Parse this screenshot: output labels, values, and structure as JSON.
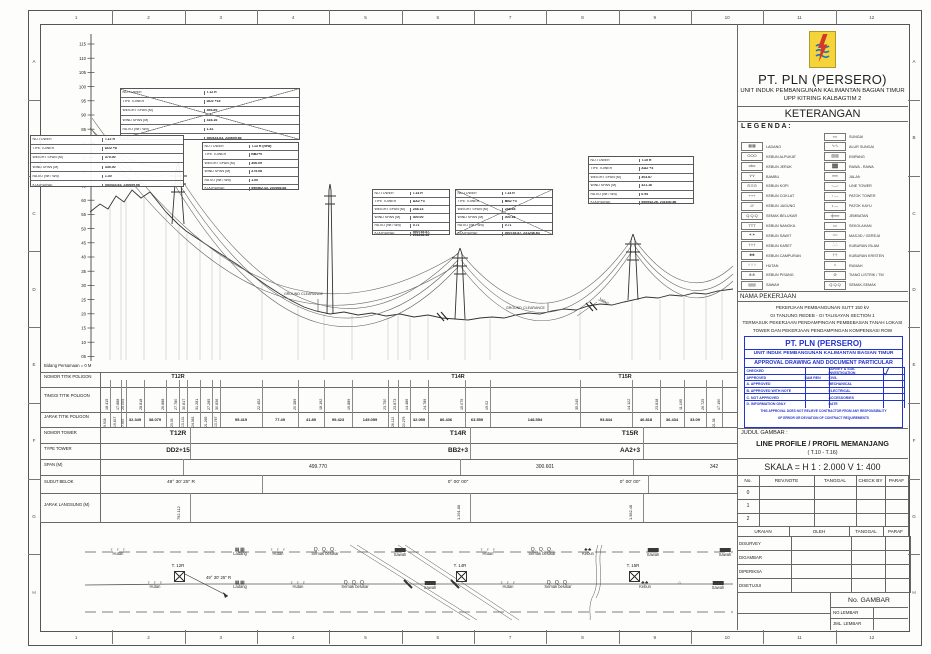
{
  "sheet": {
    "cols": [
      "1",
      "2",
      "3",
      "4",
      "5",
      "6",
      "7",
      "8",
      "9",
      "10",
      "11",
      "12"
    ],
    "rows": [
      "A",
      "B",
      "C",
      "D",
      "E",
      "F",
      "G",
      "H"
    ]
  },
  "header": {
    "company": "PT. PLN (PERSERO)",
    "unit": "UNIT INDUK PEMBANGUNAN KALIMANTAN BAGIAN TIMUR",
    "sub_unit": "UPP KITRING KALBAGTIM 2",
    "keterangan": "KETERANGAN",
    "legenda": "L E G E N D A :"
  },
  "legend_rows": [
    [
      "",
      "",
      "≈≈",
      "SUNGAI"
    ],
    [
      "▦▦",
      "LADANG",
      "∿∿",
      "ALUR SUNGAI"
    ],
    [
      "OOO",
      "KEBUN ALPUKAT",
      "▨▨",
      "EMPANG"
    ],
    [
      "obo",
      "KEBUN JERUK",
      "▓▓",
      "RAWA - RAWA"
    ],
    [
      "⋎⋎",
      "BAMBU",
      "══",
      "JALAN"
    ],
    [
      "⊙⊙⊙",
      "KEBUN KOPI",
      "▫—▫",
      "LINE TOWER"
    ],
    [
      "+++",
      "KEBUN COKLAT",
      "▫ —",
      "PATOK TOWER"
    ],
    [
      "///",
      "KEBUN JAGUNG",
      "• —",
      "PATOK KAYU"
    ],
    [
      "Q.Q.Q",
      "SEMAK BELUKAR",
      "╪══",
      "JEMBATAN"
    ],
    [
      "TTT",
      "KEBUN NANGKA",
      "▭",
      "SEKOLAHAN"
    ],
    [
      "✶✶",
      "KEBUN SAWIT",
      "⌂⌂",
      "MASJID / GEREJA"
    ],
    [
      "†††",
      "KEBUN KARET",
      "∴∴",
      "KUBURAN ISLAM"
    ],
    [
      "♣♣",
      "KEBUN CAMPURAN",
      "††",
      "KUBURAN KRISTEN"
    ],
    [
      "♀♀♀",
      "HUTAN",
      "⌂",
      "RUMAH"
    ],
    [
      "⋔⋔",
      "KEBUN PISANG",
      "⊘",
      "TIANG LISTRIK / TM"
    ],
    [
      "▤▤",
      "SAWAH",
      "Q.Q.Q",
      "SEMAK-SEMAK"
    ]
  ],
  "job": {
    "label": "NAMA PEKERJAAN",
    "lines": [
      "PEKERJAAN PEMBANGUNAN SUTT 150 kV",
      "GI TANJUNG REDEB - GI TALISAYAN SECTION 1",
      "TERMASUK PEKERJAAN PENDAMPINGAN PEMBEBASAN TANAH LOKASI",
      "TOWER DAN PEKERJAAN PENDAMPINGAN KOMPENSASI ROW"
    ]
  },
  "stamp": {
    "company": "PT. PLN (PERSERO)",
    "unit": "UNIT  INDUK PEMBANGUNAN KALIMANTAN BAGIAN TIMUR",
    "title": "APPROVAL DRAWING AND DOCUMENT PARTICULAR",
    "left": [
      "CHECKED",
      "APPROVED",
      "A. APPROVED",
      "B. APPROVED WITH NOTE",
      "C. NOT APPROVED",
      "D. INFORMATION ONLY"
    ],
    "left_vals": [
      "",
      "SAM REN",
      "",
      "",
      "",
      ""
    ],
    "right": [
      "SURVEY & SOIL INVESTIGATION",
      "CIVIL",
      "MECHANICAL",
      "ELECTRICAL",
      "ACCESSORIES",
      "DATE"
    ],
    "check_mark": "✓",
    "footer1": "THIS APPROVAL DOES NOT RELIEVE CONTRACTOR FROM ANY RESPONSIBILITY",
    "footer2": "OF ERROR OR DEVIATION OF CONTRACT REQUIREMENTS"
  },
  "title_box": {
    "label": "JUDUL GAMBAR :",
    "line1": "LINE PROFILE / PROFIL MEMANJANG",
    "line2": "( T.10 - T.16)",
    "skala": "SKALA   =   H 1 : 2.000      V 1: 400"
  },
  "rev": {
    "headers": [
      "No.",
      "REV.NOTE",
      "TANGGAL",
      "CHECK BY",
      "PARAF"
    ],
    "rows": [
      "0",
      "1",
      "2"
    ]
  },
  "uraian": {
    "headers": [
      "URAIAN",
      "OLEH",
      "TANGGAL",
      "PARAF"
    ],
    "rows": [
      "DISURVEY",
      "DIGAMBAR",
      "DIPERIKSA",
      "DISETUJUI"
    ]
  },
  "numbers": {
    "no_gambar": "No. GAMBAR",
    "no_lembar": "NO.LEMBAR",
    "jml_lembar": "JML. LEMBAR"
  },
  "profile": {
    "datum": "Bidang Persamaan = 0 M",
    "axis": [
      "115",
      "110",
      "105",
      "100",
      "95",
      "90",
      "85",
      "80",
      "75",
      "70",
      "65",
      "60",
      "55",
      "50",
      "45",
      "40",
      "35",
      "30",
      "25",
      "20",
      "15",
      "10",
      "05"
    ],
    "gc": "GROUND CLEARANCE",
    "jalan": "Jalan",
    "row_labels": [
      "NO.TOWER",
      "TIPE TOWER",
      "WEIGHT SPAN (M)",
      "WIND SPAN (M)",
      "RATIO (Wt / Wd)",
      "KOORDINAT"
    ],
    "tables": [
      {
        "x": 120,
        "y": 88,
        "w": 178,
        "h": 50,
        "crossed": true,
        "vals": [
          "T.12 R",
          "DD2 +15",
          "494.89",
          "416.16",
          "1.41",
          "550434.63, 230659.66"
        ]
      },
      {
        "x": 30,
        "y": 135,
        "w": 152,
        "h": 50,
        "crossed": false,
        "vals": [
          "T.12 R",
          "DD2 +8",
          "375.00",
          "335.00",
          "1.30",
          "550434.63, 230659.66"
        ]
      },
      {
        "x": 202,
        "y": 142,
        "w": 95,
        "h": 46,
        "crossed": false,
        "vals": [
          "T.13 R (new)",
          "BB2+0",
          "306.09",
          "375.08",
          "1.00",
          "550562.43, 230936.88"
        ]
      },
      {
        "x": 372,
        "y": 189,
        "w": 76,
        "h": 44,
        "crossed": false,
        "vals": [
          "T.14 R",
          "AA2 +3",
          "248.13",
          "300.00",
          "0.71",
          "550745.87, 231246.63"
        ]
      },
      {
        "x": 455,
        "y": 189,
        "w": 96,
        "h": 44,
        "crossed": true,
        "vals": [
          "T.14 R",
          "BB2 +3",
          "248.48",
          "400.16",
          "0.71",
          "550745.87, 231246.63"
        ]
      },
      {
        "x": 588,
        "y": 156,
        "w": 104,
        "h": 46,
        "crossed": false,
        "vals": [
          "T.15 R",
          "AA2 +3",
          "303.67",
          "321.16",
          "0.94",
          "550943.26, 231630.86"
        ]
      }
    ]
  },
  "band": {
    "labels": [
      "NOMOR TITIK POLIGON",
      "TINGGI TITIK POLIGON",
      "JARAK TITIK POLIGON",
      "NOMOR TOWER",
      "TYPE TOWER",
      "SPAN (M)",
      "SUDUT BELOK",
      "JARAK LANGSUNG (M)"
    ],
    "stations": [
      110,
      121,
      126,
      144,
      166,
      179,
      187,
      200,
      212,
      220,
      262,
      298,
      324,
      352,
      388,
      398,
      410,
      428,
      465,
      490,
      580,
      632,
      660,
      684,
      706,
      722
    ],
    "tinggi": [
      "18.415",
      "17.888",
      "25.005",
      "28.818",
      "26.888",
      "27.780",
      "30.817",
      "31.281",
      "27.285",
      "30.836",
      "22.452",
      "20.389",
      "18.192",
      "19.889",
      "23.750",
      "23.873",
      "14.486",
      "24.789",
      "15.075",
      "19.02",
      "35.245",
      "14.122",
      "23.818",
      "11.195",
      "26.725",
      "17.190"
    ],
    "jarak": [
      [
        "9.908",
        105,
        1
      ],
      [
        "19.817",
        115,
        1
      ],
      [
        "7.957",
        123,
        1
      ],
      [
        "32.349",
        135,
        0
      ],
      [
        "38.079",
        155,
        0
      ],
      [
        "23.35",
        172,
        1
      ],
      [
        "13.131",
        183,
        1
      ],
      [
        "24.363",
        193,
        1
      ],
      [
        "21.265",
        206,
        1
      ],
      [
        "13.747",
        216,
        1
      ],
      [
        "95.419",
        241,
        0
      ],
      [
        "77.49",
        280,
        0
      ],
      [
        "41.89",
        311,
        0
      ],
      [
        "99.423",
        338,
        0
      ],
      [
        "145.059",
        370,
        0
      ],
      [
        "26.112",
        393,
        1
      ],
      [
        "20.279",
        404,
        1
      ],
      [
        "32.059",
        419,
        0
      ],
      [
        "86.436",
        446,
        0
      ],
      [
        "63.559",
        477,
        0
      ],
      [
        "148.554",
        535,
        0
      ],
      [
        "93.844",
        606,
        0
      ],
      [
        "46.818",
        646,
        0
      ],
      [
        "36.434",
        672,
        0
      ],
      [
        "33.09",
        695,
        0
      ],
      [
        "21.36",
        714,
        1
      ]
    ],
    "poligon_towers": [
      [
        "T12R",
        178
      ],
      [
        "T14R",
        458
      ],
      [
        "T15R",
        625
      ]
    ],
    "nomor": [
      [
        "T12R",
        178
      ],
      [
        "T14R",
        458
      ],
      [
        "T15R",
        630
      ]
    ],
    "type": [
      [
        "DD2+15",
        178
      ],
      [
        "BB2+3",
        458
      ],
      [
        "AA2+3",
        630
      ]
    ],
    "span": [
      [
        "499.770",
        318
      ],
      [
        "300.601",
        545
      ],
      [
        "342",
        714
      ]
    ],
    "sudut": [
      [
        "49° 30' 25\" R",
        181
      ],
      [
        "0° 00' 00\"",
        458
      ],
      [
        "0° 00' 00\"",
        630
      ]
    ],
    "jarak_langsung": [
      [
        "792.112",
        178
      ],
      [
        "1.291.88",
        458
      ],
      [
        "1.582.48",
        630
      ]
    ]
  },
  "plan": {
    "angle": "49° 30' 25\" R",
    "towers": [
      [
        "T. 12R",
        178
      ],
      [
        "T. 14R",
        460
      ],
      [
        "T. 15R",
        633
      ]
    ],
    "items_top": [
      [
        "hutan",
        "Hutan",
        118
      ],
      [
        "ladang",
        "Ladang",
        240
      ],
      [
        "hutan",
        "Hutan",
        278
      ],
      [
        "semak",
        "Semak belukar",
        325
      ],
      [
        "sawah",
        "Sawah",
        400
      ],
      [
        "hutan",
        "Hutan",
        488
      ],
      [
        "semak",
        "Semak belukar",
        542
      ],
      [
        "kebun",
        "Kebun",
        588
      ],
      [
        "sawah",
        "Sawah",
        653
      ],
      [
        "sawah",
        "Sawah",
        725
      ]
    ],
    "items_bottom": [
      [
        "hutan",
        "Hutan",
        155
      ],
      [
        "ladang",
        "Ladang",
        240
      ],
      [
        "hutan",
        "Hutan",
        298
      ],
      [
        "semak",
        "Semak belukar",
        355
      ],
      [
        "sawah",
        "Sawah",
        430
      ],
      [
        "hutan",
        "Hutan",
        508
      ],
      [
        "semak",
        "Semak belukar",
        558
      ],
      [
        "kebun",
        "Kebun",
        645
      ],
      [
        "house",
        "",
        680
      ],
      [
        "sawah",
        "Sawah",
        718
      ]
    ]
  },
  "colors": {
    "stamp_blue": "#2433c9",
    "logo_yellow": "#f5d43a",
    "logo_red": "#d0392e",
    "logo_blue": "#1e74c6",
    "line": "#555555"
  }
}
